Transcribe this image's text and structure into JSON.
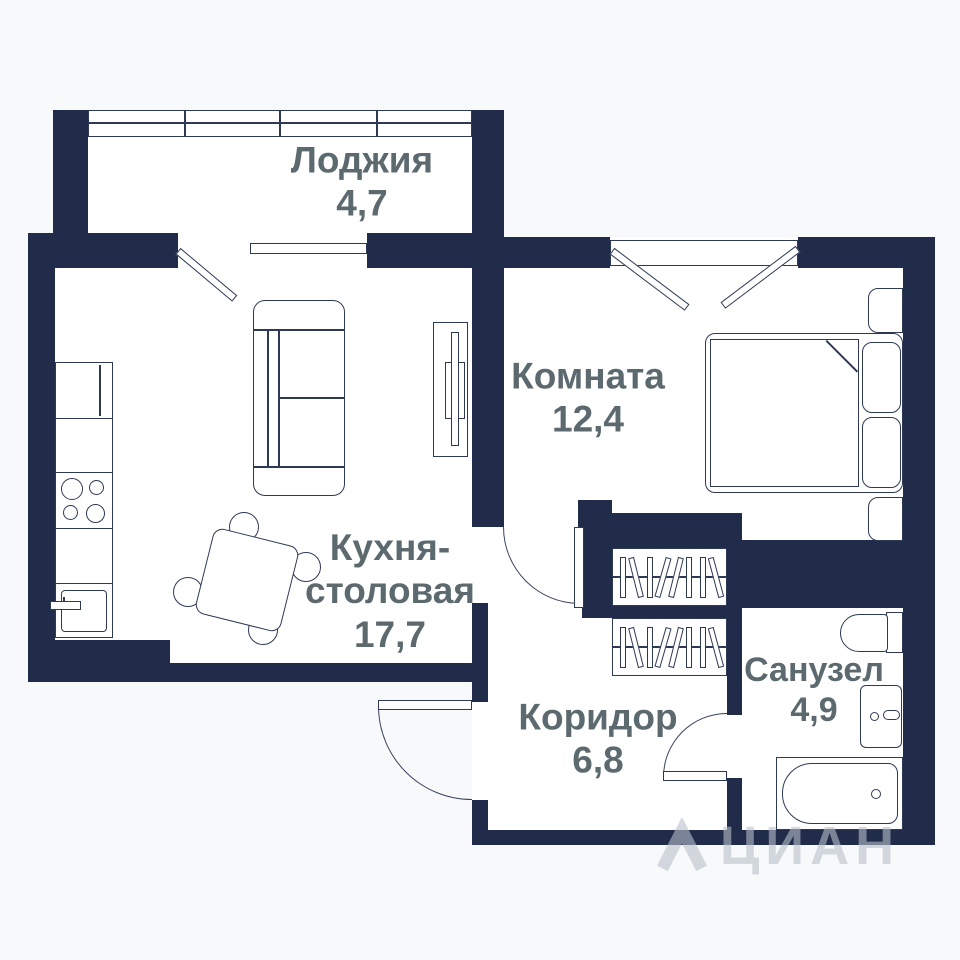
{
  "plan": {
    "title": "Floor plan of 1-room apartment",
    "rooms": {
      "loggia": {
        "name": "Лоджия",
        "area": "4,7"
      },
      "bedroom": {
        "name": "Комната",
        "area": "12,4"
      },
      "kitchen": {
        "line1": "Кухня-",
        "line2": "столовая",
        "area": "17,7"
      },
      "corridor": {
        "name": "Коридор",
        "area": "6,8"
      },
      "bathroom": {
        "name": "Санузел",
        "area": "4,9"
      }
    },
    "watermark": {
      "text": "ЦИАН"
    },
    "colors": {
      "wall": "#202c4a",
      "furniture_line": "#2e3a55",
      "label_text": "#5c6a70",
      "background": "#f8f9fa",
      "interior": "#ffffff",
      "watermark": "rgba(185,192,203,0.6)"
    }
  }
}
